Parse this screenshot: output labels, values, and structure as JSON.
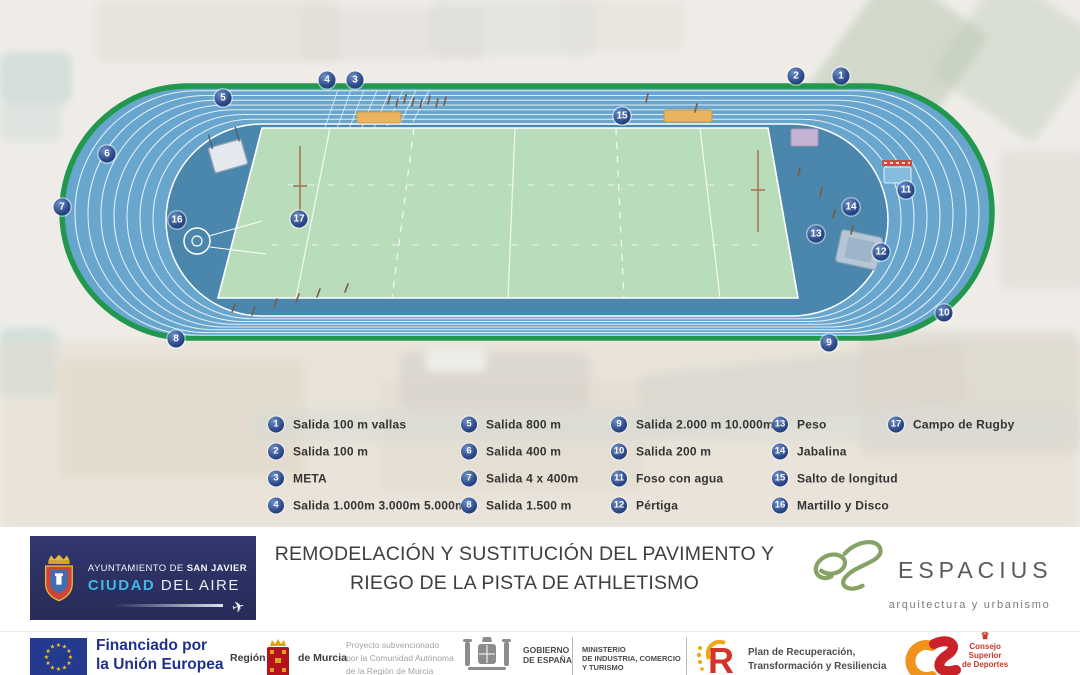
{
  "track": {
    "markers": [
      {
        "n": 1,
        "x": 841,
        "y": 76
      },
      {
        "n": 2,
        "x": 796,
        "y": 76
      },
      {
        "n": 3,
        "x": 355,
        "y": 80
      },
      {
        "n": 4,
        "x": 327,
        "y": 80
      },
      {
        "n": 5,
        "x": 223,
        "y": 98
      },
      {
        "n": 6,
        "x": 107,
        "y": 154
      },
      {
        "n": 7,
        "x": 62,
        "y": 207
      },
      {
        "n": 8,
        "x": 176,
        "y": 339
      },
      {
        "n": 9,
        "x": 829,
        "y": 343
      },
      {
        "n": 10,
        "x": 944,
        "y": 313
      },
      {
        "n": 11,
        "x": 906,
        "y": 190
      },
      {
        "n": 12,
        "x": 881,
        "y": 252
      },
      {
        "n": 13,
        "x": 816,
        "y": 234
      },
      {
        "n": 14,
        "x": 851,
        "y": 207
      },
      {
        "n": 15,
        "x": 622,
        "y": 116
      },
      {
        "n": 16,
        "x": 177,
        "y": 220
      },
      {
        "n": 17,
        "x": 299,
        "y": 219
      }
    ]
  },
  "legend": {
    "columns": [
      [
        {
          "n": 1,
          "label": "Salida 100 m vallas"
        },
        {
          "n": 2,
          "label": "Salida 100 m"
        },
        {
          "n": 3,
          "label": "META"
        },
        {
          "n": 4,
          "label": "Salida 1.000m 3.000m 5.000m"
        }
      ],
      [
        {
          "n": 5,
          "label": "Salida 800 m"
        },
        {
          "n": 6,
          "label": "Salida 400 m"
        },
        {
          "n": 7,
          "label": "Salida 4 x 400m"
        },
        {
          "n": 8,
          "label": "Salida 1.500 m"
        }
      ],
      [
        {
          "n": 9,
          "label": "Salida 2.000 m 10.000m"
        },
        {
          "n": 10,
          "label": "Salida 200 m"
        },
        {
          "n": 11,
          "label": "Foso con agua"
        },
        {
          "n": 12,
          "label": "Pértiga"
        }
      ],
      [
        {
          "n": 13,
          "label": "Peso"
        },
        {
          "n": 14,
          "label": "Jabalina"
        },
        {
          "n": 15,
          "label": "Salto de longitud"
        },
        {
          "n": 16,
          "label": "Martillo y Disco"
        }
      ],
      [
        {
          "n": 17,
          "label": "Campo de Rugby"
        }
      ]
    ]
  },
  "footer": {
    "municipality": {
      "line1_prefix": "AYUNTAMIENTO DE ",
      "line1_bold": "SAN JAVIER",
      "line2_accent": "CIUDAD",
      "line2_rest": " DEL AIRE"
    },
    "title_line1": "REMODELACIÓN Y SUSTITUCIÓN DEL PAVIMENTO Y",
    "title_line2": "RIEGO DE LA PISTA DE ATHLETISMO",
    "studio": {
      "name": "ESPACIUS",
      "tagline": "arquitectura y urbanismo"
    }
  },
  "funding": {
    "eu": {
      "line1": "Financiado por",
      "line2": "la Unión Europea",
      "line3": "NextGenerationEU"
    },
    "murcia": {
      "left": "Región",
      "right": "de Murcia",
      "note_lines": [
        "Proyecto subvencionado",
        "por la Comunidad Autónoma",
        "de la Región de Murcia"
      ]
    },
    "spain": {
      "gov_line1": "GOBIERNO",
      "gov_line2": "DE ESPAÑA",
      "ministry_lines": [
        "MINISTERIO",
        "DE INDUSTRIA, COMERCIO",
        "Y TURISMO"
      ]
    },
    "prtr": {
      "letter": "R",
      "line1": "Plan de Recuperación,",
      "line2": "Transformación y Resiliencia"
    },
    "csd": {
      "lines": [
        "Consejo",
        "Superior",
        "de Deportes"
      ]
    }
  },
  "icons": {
    "plane": "✈",
    "crown": "♛"
  },
  "colors": {
    "track_blue": "#68a6ce",
    "infield_blue": "#4b86ac",
    "rugby_green": "#b9dcba",
    "border_green": "#21984e",
    "marker_navy": "#2a4787",
    "eu_navy": "#20308d",
    "murcia_red": "#b5121b",
    "prtr_red": "#d2342a",
    "prtr_yellow": "#f2a70c",
    "csd_orange": "#f0921e",
    "csd_red": "#cb2128",
    "espacius_green": "#87a265",
    "sanjavier_navy": "#2b3063",
    "ciudad_blue": "#41b6e8"
  }
}
